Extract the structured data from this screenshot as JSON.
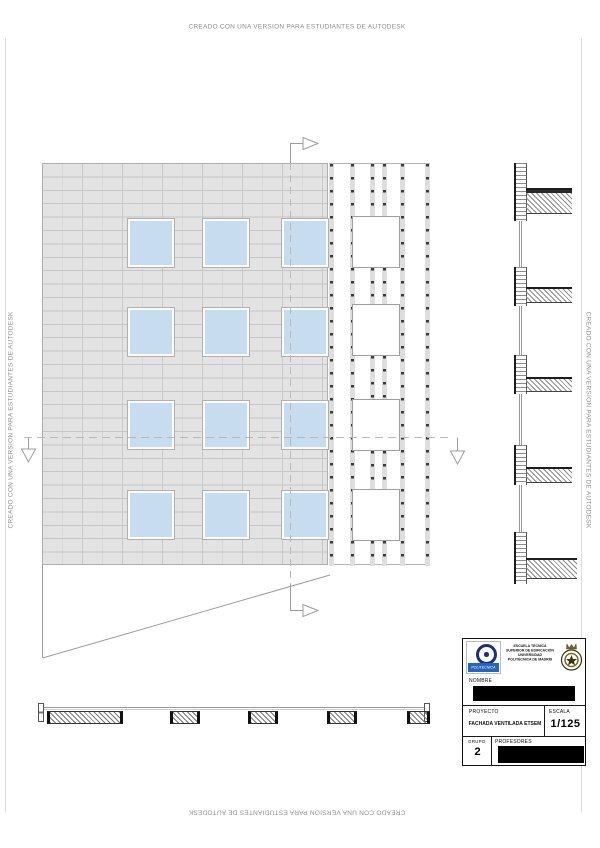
{
  "watermark": {
    "text": "CREADO CON UNA VERSION PARA ESTUDIANTES DE AUTODESK"
  },
  "colors": {
    "tile_fill": "#e3e3e3",
    "tile_joint": "#c6c6c6",
    "window_fill": "#c8dcf0",
    "line_grey": "#9c9c9c",
    "banner_blue": "#2465c2",
    "upm_navy": "#1c2f7a",
    "crest_gold": "#7a6a2a",
    "redaction": "#000000"
  },
  "drawing": {
    "facade": {
      "rows": [
        55,
        144,
        237,
        327
      ],
      "cols": [
        85,
        160,
        239
      ],
      "win_w": 46,
      "win_h": 48
    },
    "strip": {
      "height": 402,
      "rails_full": [
        0,
        21,
        71,
        96
      ],
      "rails_short": [
        41,
        53
      ],
      "spandrels": [
        [
          0,
          52
        ],
        [
          104,
          140
        ],
        [
          192,
          235
        ],
        [
          287,
          325
        ],
        [
          377,
          402
        ]
      ],
      "openings_y": [
        52,
        140,
        235,
        325
      ],
      "opening_h": 52
    },
    "section": {
      "units": [
        {
          "wy": 2,
          "wh": 58,
          "sy": 27,
          "sh": 26,
          "sw": 46
        },
        {
          "wy": 106,
          "wh": 39,
          "sy": 126,
          "sh": 16,
          "sw": 46
        },
        {
          "wy": 194,
          "wh": 39,
          "sy": 216,
          "sh": 15,
          "sw": 46
        },
        {
          "wy": 284,
          "wh": 40,
          "sy": 306,
          "sh": 16,
          "sw": 46
        },
        {
          "wy": 371,
          "wh": 52,
          "sy": 397,
          "sh": 21,
          "sw": 51
        }
      ],
      "glazing": [
        [
          60,
          106
        ],
        [
          145,
          194
        ],
        [
          233,
          284
        ],
        [
          324,
          371
        ]
      ]
    },
    "plan": {
      "segments": [
        {
          "x": 9,
          "w": 76
        },
        {
          "x": 132,
          "w": 30
        },
        {
          "x": 210,
          "w": 30
        },
        {
          "x": 289,
          "w": 30
        },
        {
          "x": 369,
          "w": 23
        }
      ]
    }
  },
  "title_block": {
    "school_lines": [
      "ESCUELA TÉCNICA",
      "SUPERIOR DE EDIFICACIÓN",
      "UNIVERSIDAD",
      "POLITÉCNICA DE MADRID"
    ],
    "logo_banner": "POLITECNICA",
    "nombre_label": "NOMBRE",
    "proyecto_label": "PROYECTO",
    "proyecto_value": "FACHADA VENTILADA ETSEM",
    "escala_label": "ESCALA",
    "escala_value": "1/125",
    "grupo_label": "GRUPO",
    "grupo_value": "2",
    "profesores_label": "PROFESORES"
  }
}
